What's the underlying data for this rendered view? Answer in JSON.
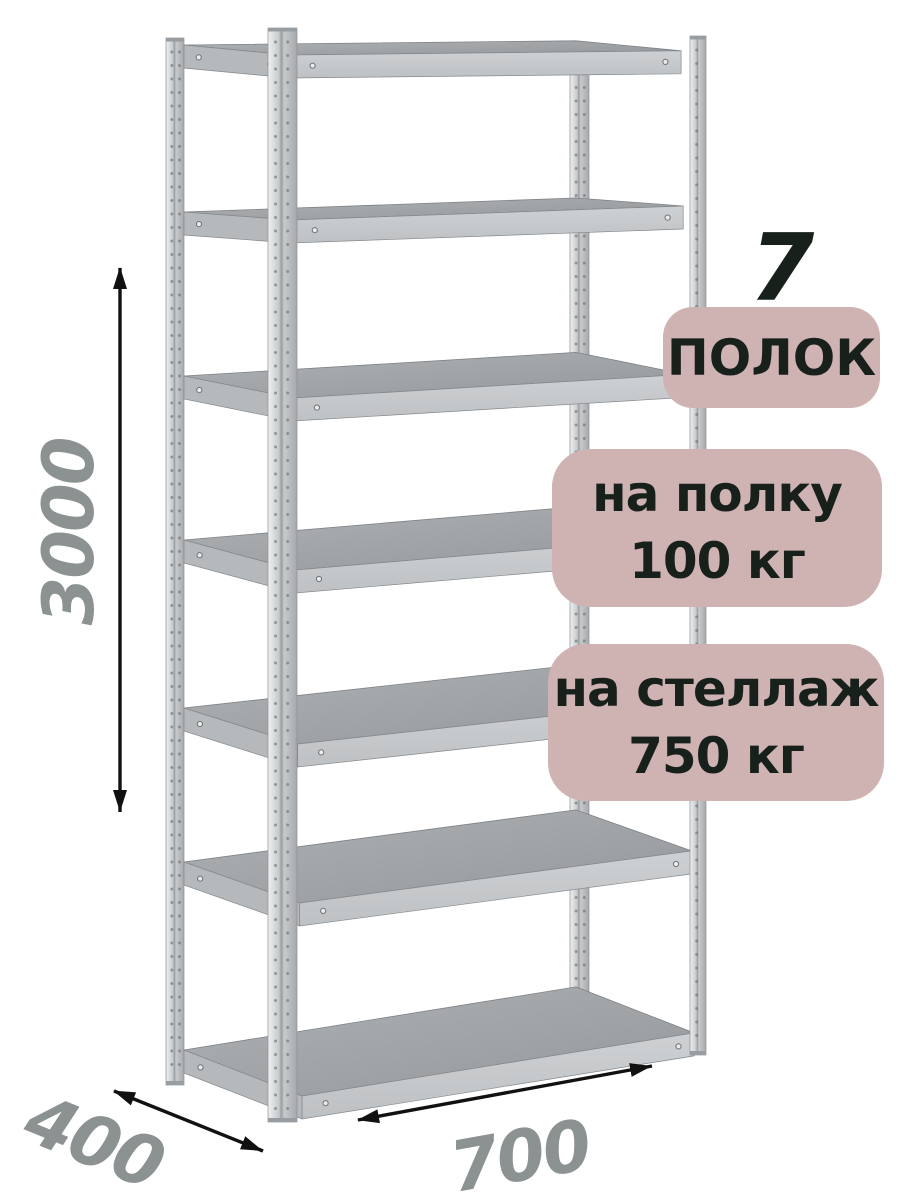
{
  "page": {
    "background": "#ffffff"
  },
  "rack": {
    "shelf_count": 7
  },
  "dimensions": {
    "height_mm": "3000",
    "depth_mm": "400",
    "width_mm": "700"
  },
  "badges": {
    "count_number": "7",
    "count_label": "ПОЛОК",
    "shelf_load": {
      "line1": "на полку",
      "line2": "100 кг"
    },
    "rack_load": {
      "line1": "на стеллаж",
      "line2": "750 кг"
    }
  },
  "colors": {
    "badge_bg": "#cfb3b3",
    "badge_text": "#18201b",
    "dimension_text": "#8c9191",
    "arrow": "#111111",
    "metal_light": "#eef0f1",
    "metal_mid": "#c7cacc",
    "metal_dark": "#a6a9ac",
    "metal_seam": "#9b9ea1",
    "shelf_top_light": "#aeb1b4",
    "shelf_top_dark": "#94989b",
    "shelf_band_light": "#ced1d3",
    "shelf_band_dark": "#bec1c3",
    "shelf_side": "#b6b9bb"
  }
}
